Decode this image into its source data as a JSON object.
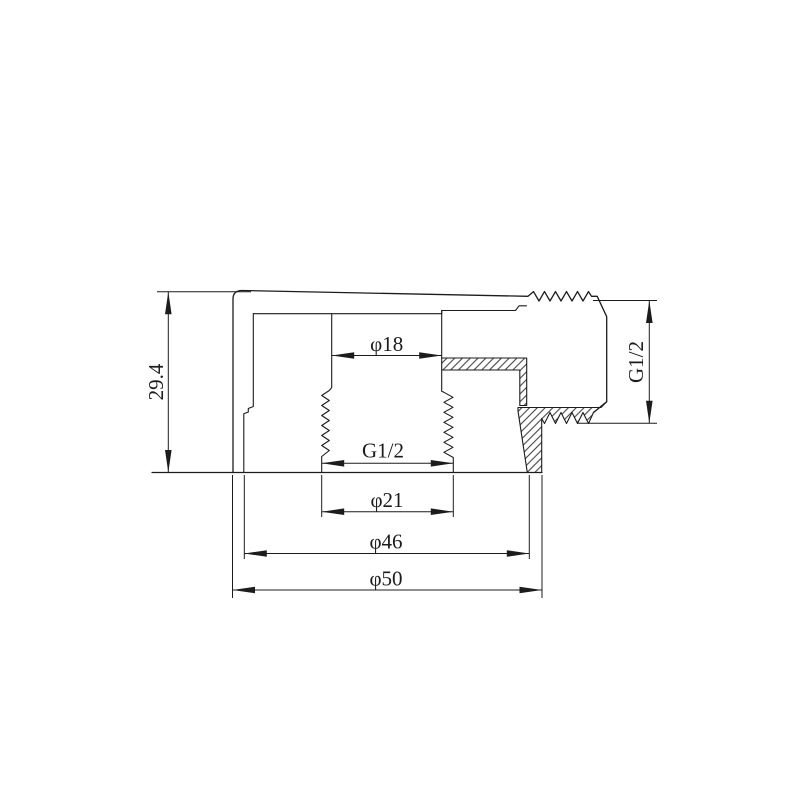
{
  "drawing": {
    "kind": "technical-section-drawing",
    "colors": {
      "line": "#1c1c1c",
      "background": "#ffffff"
    }
  },
  "dimensions": {
    "height": "29.4",
    "bore_diameter": "φ18",
    "internal_thread": "G1/2",
    "thread_major_diameter": "φ21",
    "inner_body_diameter": "φ46",
    "outer_body_diameter": "φ50",
    "outlet_thread": "G1/2"
  }
}
